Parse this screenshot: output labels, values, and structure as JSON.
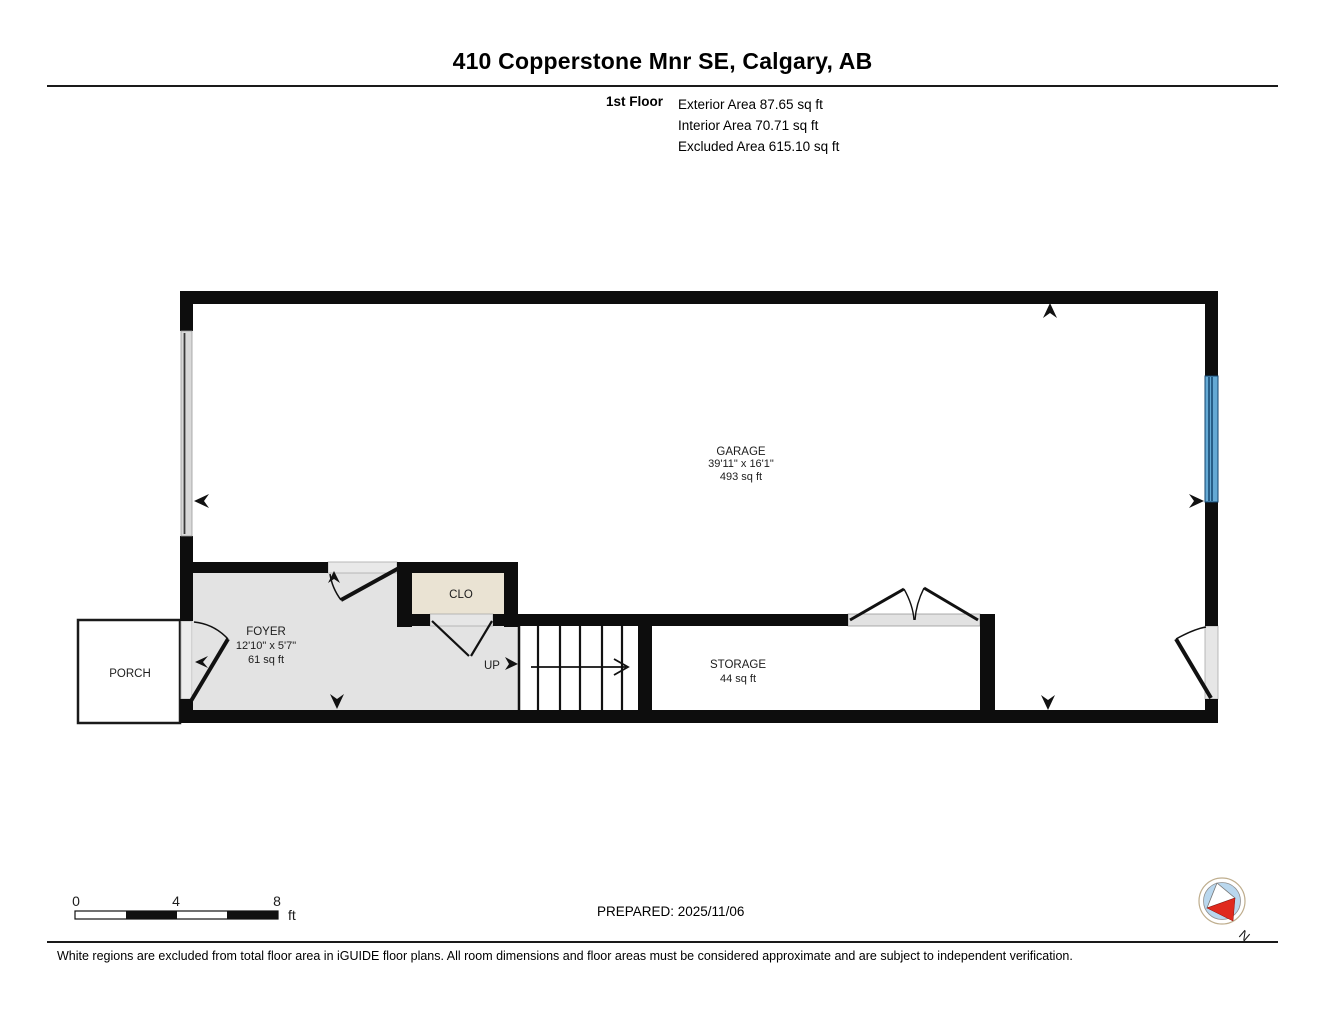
{
  "header": {
    "title": "410 Copperstone Mnr SE, Calgary, AB",
    "floor_label": "1st Floor",
    "stats": [
      "Exterior Area 87.65 sq ft",
      "Interior Area 70.71 sq ft",
      "Excluded Area 615.10 sq ft"
    ]
  },
  "rooms": {
    "garage": {
      "name": "GARAGE",
      "dimensions": "39'11\" x 16'1\"",
      "area": "493 sq ft"
    },
    "foyer": {
      "name": "FOYER",
      "dimensions": "12'10\" x 5'7\"",
      "area": "61 sq ft"
    },
    "closet": {
      "name": "CLO"
    },
    "storage": {
      "name": "STORAGE",
      "area": "44 sq ft"
    },
    "porch": {
      "name": "PORCH"
    },
    "stairs": {
      "direction_label": "UP"
    }
  },
  "scale_bar": {
    "ticks": [
      "0",
      "4",
      "8"
    ],
    "unit": "ft"
  },
  "compass": {
    "north_label": "N"
  },
  "footer": {
    "prepared": "PREPARED: 2025/11/06",
    "disclaimer": "White regions are excluded from total floor area in iGUIDE floor plans. All room dimensions and floor areas must be considered approximate and are subject to independent verification."
  },
  "colors": {
    "wall": "#0d0d0d",
    "foyer_floor": "#e3e3e3",
    "closet_floor": "#eae3d3",
    "window": "#64a9d4",
    "compass_red": "#e02a1e"
  }
}
